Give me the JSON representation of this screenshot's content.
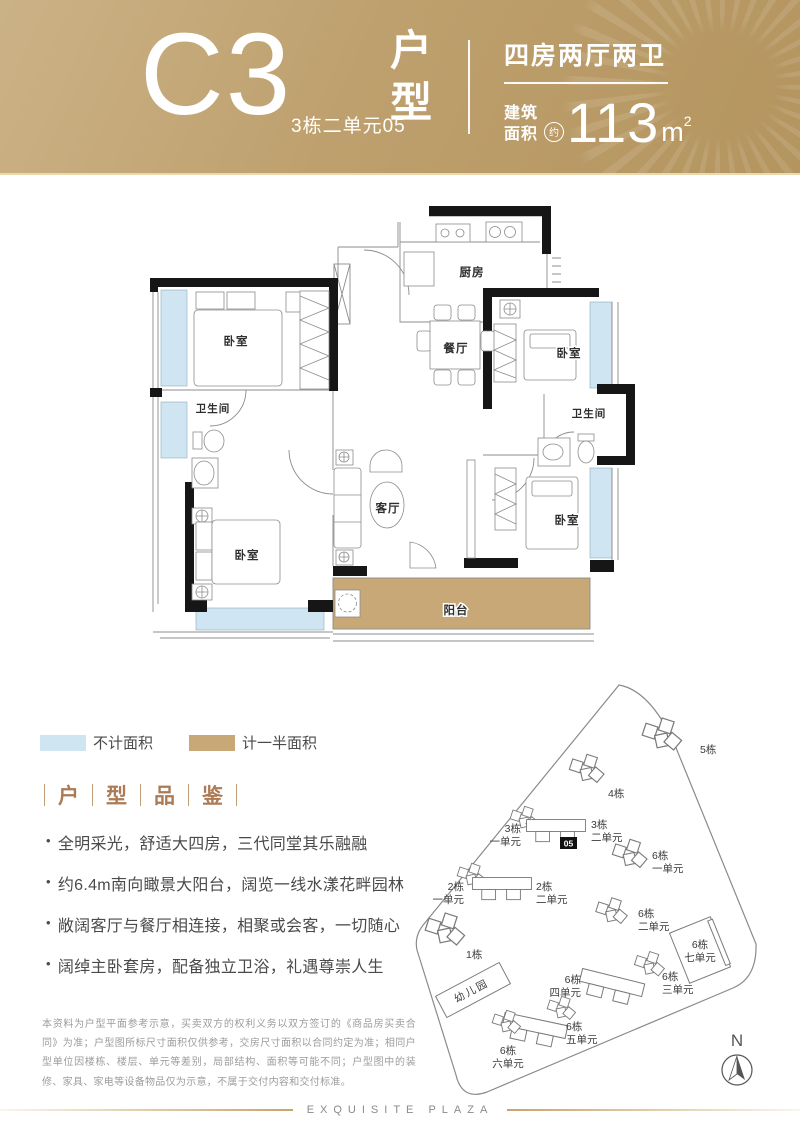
{
  "colors": {
    "gold": "#bd9f6f",
    "gold_light": "#cbb286",
    "blue": "#cfe5f2",
    "tan": "#c8a877",
    "accent_brown": "#ac7b55",
    "wall_black": "#161616",
    "line_gray": "#8c8c8c"
  },
  "header": {
    "unit_code": "C3",
    "unit_location": "3栋二单元05",
    "type_chars": [
      "户",
      "型"
    ],
    "layout": "四房两厅两卫",
    "area_label_line1": "建筑",
    "area_label_line2": "面积",
    "area_approx": "约",
    "area_value": "113",
    "area_unit": "m",
    "area_unit_sup": "2"
  },
  "floor_plan": {
    "rooms": [
      {
        "label": "厨房"
      },
      {
        "label": "餐厅"
      },
      {
        "label": "卧室"
      },
      {
        "label": "卧室"
      },
      {
        "label": "卫生间"
      },
      {
        "label": "卫生间"
      },
      {
        "label": "客厅"
      },
      {
        "label": "卧室"
      },
      {
        "label": "卧室"
      },
      {
        "label": "阳台"
      }
    ]
  },
  "legend": {
    "items": [
      {
        "label": "不计面积",
        "color": "#cfe5f2"
      },
      {
        "label": "计一半面积",
        "color": "#c8a877"
      }
    ]
  },
  "section": {
    "title_chars": [
      "户",
      "型",
      "品",
      "鉴"
    ],
    "bullet": "•",
    "bullets": [
      "全明采光，舒适大四房，三代同堂其乐融融",
      "约6.4m南向瞰景大阳台，阔览一线水漾花畔园林",
      "敞阔客厅与餐厅相连接，相聚或会客，一切随心",
      "阔绰主卧套房，配备独立卫浴，礼遇尊崇人生"
    ]
  },
  "disclaimer": "本资料为户型平面参考示意，买卖双方的权利义务以双方签订的《商品房买卖合同》为准；户型图所标尺寸面积仅供参考，交房尺寸面积以合同约定为准；相同户型单位因楼栋、楼层、单元等差别，局部结构、面积等可能不同；户型图中的装修、家具、家电等设备物品仅为示意，不属于交付内容和交付标准。",
  "site_plan": {
    "unit_badge": "05",
    "compass_label": "N",
    "buildings": [
      {
        "line1": "5栋"
      },
      {
        "line1": "4栋"
      },
      {
        "line1": "3栋",
        "line2": "一单元"
      },
      {
        "line1": "3栋",
        "line2": "二单元"
      },
      {
        "line1": "6栋",
        "line2": "一单元"
      },
      {
        "line1": "2栋",
        "line2": "一单元"
      },
      {
        "line1": "2栋",
        "line2": "二单元"
      },
      {
        "line1": "6栋",
        "line2": "二单元"
      },
      {
        "line1": "6栋",
        "line2": "七单元"
      },
      {
        "line1": "1栋"
      },
      {
        "line1": "幼儿园"
      },
      {
        "line1": "6栋",
        "line2": "四单元"
      },
      {
        "line1": "6栋",
        "line2": "三单元"
      },
      {
        "line1": "6栋",
        "line2": "五单元"
      },
      {
        "line1": "6栋",
        "line2": "六单元"
      }
    ]
  },
  "footer": {
    "brand": "EXQUISITE PLAZA"
  }
}
